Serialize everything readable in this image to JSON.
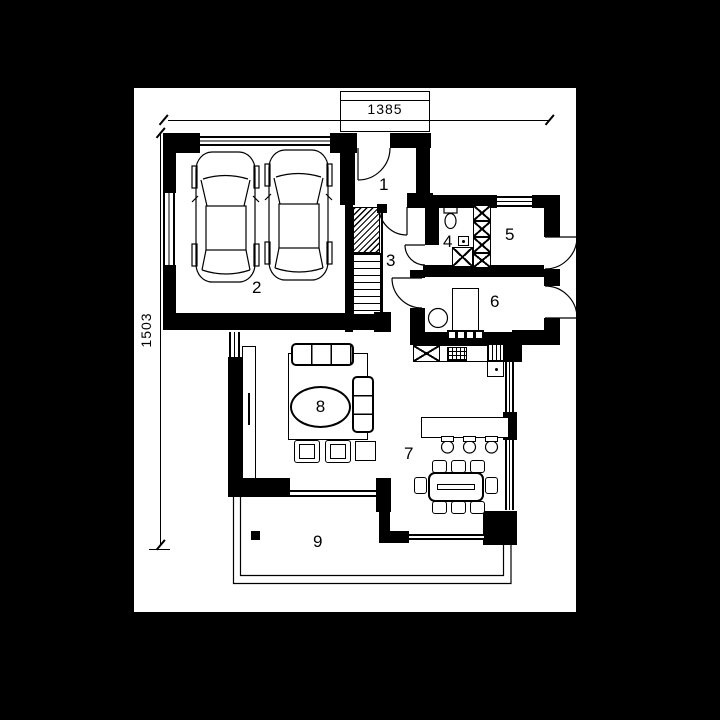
{
  "title": "house-ground-floor-plan",
  "dimensions": {
    "width_label": "1385",
    "height_label": "1503"
  },
  "rooms": [
    {
      "number": "1"
    },
    {
      "number": "2"
    },
    {
      "number": "3"
    },
    {
      "number": "4"
    },
    {
      "number": "5"
    },
    {
      "number": "6"
    },
    {
      "number": "7"
    },
    {
      "number": "8"
    },
    {
      "number": "9"
    }
  ],
  "colors": {
    "ink": "#000000",
    "paper": "#ffffff",
    "backdrop": "#000000"
  }
}
